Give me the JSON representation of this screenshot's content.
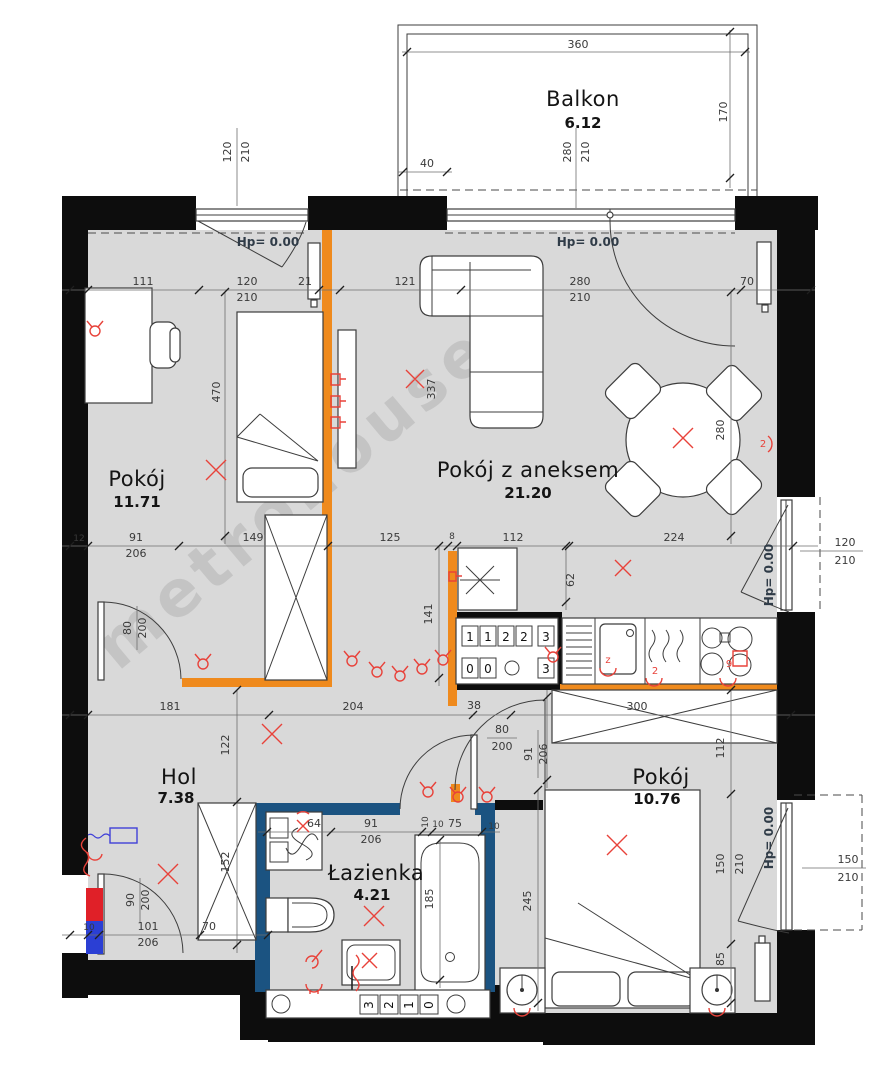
{
  "watermark": "metrohouse",
  "rooms": {
    "balkon": {
      "name": "Balkon",
      "area": "6.12"
    },
    "pokoj_a": {
      "name": "Pokój",
      "area": "11.71"
    },
    "salon": {
      "name": "Pokój z aneksem",
      "area": "21.20"
    },
    "hol": {
      "name": "Hol",
      "area": "7.38"
    },
    "lazienka": {
      "name": "Łazienka",
      "area": "4.21"
    },
    "pokoj_b": {
      "name": "Pokój",
      "area": "10.76"
    }
  },
  "level_marks": {
    "a": "Hp= 0.00",
    "b": "Hp= 0.00",
    "c": "Hp= 0.00",
    "d": "Hp= 0.00"
  },
  "dims": {
    "balcony": {
      "width": "360",
      "depth": "170",
      "offset": "40",
      "door": [
        "280",
        "210"
      ]
    },
    "window_tl": [
      "120",
      "210"
    ],
    "row1": [
      "111",
      "120",
      "210",
      "21",
      "121",
      "280",
      "210",
      "70"
    ],
    "row2": [
      "12",
      "91",
      "206",
      "149",
      "125",
      "8",
      "112",
      "224"
    ],
    "row3": [
      "181",
      "204",
      "38",
      "300"
    ],
    "kitchen_door": [
      "120",
      "210"
    ],
    "bed_window": [
      "150",
      "210"
    ],
    "v": {
      "room_a": "470",
      "tv": "337",
      "salon": "280",
      "k62": "62",
      "k141": "141",
      "hol_up": "122",
      "ward": "152",
      "bed_door_w": "91",
      "bed_door_h": "206",
      "pass": "112",
      "bed": "245",
      "win_w": "150",
      "win_h": "210",
      "low": "85",
      "tub": "185",
      "bath10": "10"
    },
    "door_hol": [
      "80",
      "200"
    ],
    "door_entry": [
      "90",
      "200"
    ],
    "door_pass": [
      "80",
      "200"
    ],
    "hol_bottom": [
      "10",
      "101",
      "206",
      "70"
    ],
    "bath_row": [
      "64",
      "91",
      "206",
      "10",
      "75",
      "10"
    ]
  },
  "shaft": {
    "top": [
      "1",
      "1",
      "2",
      "2",
      "3"
    ],
    "bottom": [
      "0",
      "0",
      "3"
    ],
    "lower": [
      "3",
      "2",
      "1",
      "0"
    ]
  },
  "red_labels": {
    "wall": "2",
    "hob": "2",
    "burners": "9",
    "sink": "z"
  }
}
